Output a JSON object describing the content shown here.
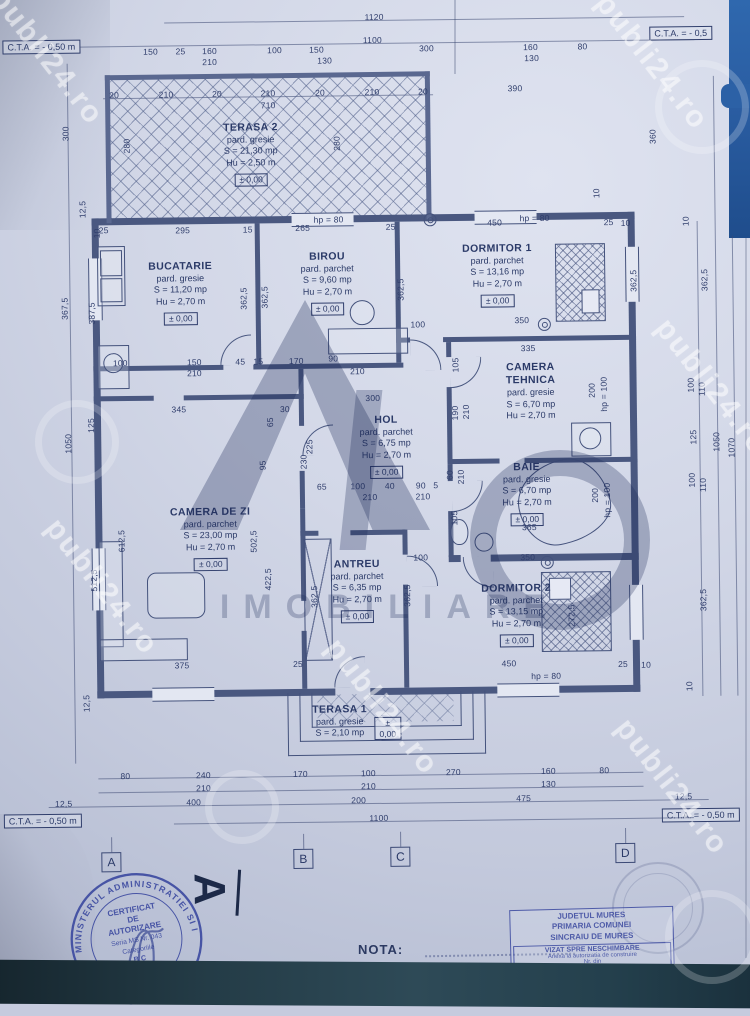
{
  "cta": {
    "top_left": "C.T.A. = - 0,50 m",
    "top_right": "C.T.A. = - 0,5",
    "bottom_left": "C.T.A. = - 0,50 m",
    "bottom_right": "C.T.A. = - 0,50 m"
  },
  "nota": "NOTA:",
  "section_marker": "A",
  "watermark": {
    "site": "publi24.ro",
    "logo_text": "IMOBILIARE"
  },
  "grid_letters": [
    {
      "t": "A",
      "x": 107,
      "y": 849
    },
    {
      "t": "B",
      "x": 299,
      "y": 848
    },
    {
      "t": "C",
      "x": 396,
      "y": 847
    },
    {
      "t": "D",
      "x": 621,
      "y": 846
    }
  ],
  "rooms": [
    {
      "name": "TERASA 2",
      "lines": [
        "pard. gresie",
        "S = 21,30 mp",
        "Hu = 2,50 m"
      ],
      "elev": "± 0,00",
      "x": 255,
      "y": 120
    },
    {
      "name": "BUCATARIE",
      "lines": [
        "pard. gresie",
        "S = 11,20 mp",
        "Hu = 2,70 m"
      ],
      "elev": "± 0,00",
      "x": 183,
      "y": 258
    },
    {
      "name": "BIROU",
      "lines": [
        "pard. parchet",
        "S = 9,60 mp",
        "Hu = 2,70 m"
      ],
      "elev": "± 0,00",
      "x": 330,
      "y": 250
    },
    {
      "name": "DORMITOR 1",
      "lines": [
        "pard. parchet",
        "S = 13,16 mp",
        "Hu = 2,70 m"
      ],
      "elev": "± 0,00",
      "x": 500,
      "y": 244
    },
    {
      "name": "CAMERA TEHNICA",
      "lines": [
        "pard. gresie",
        "S = 6,70 mp",
        "Hu = 2,70 m"
      ],
      "elev": "",
      "x": 532,
      "y": 363,
      "nameWidth": 70
    },
    {
      "name": "HOL",
      "lines": [
        "pard. parchet",
        "S = 6,75 mp",
        "Hu = 2,70 m"
      ],
      "elev": "± 0,00",
      "x": 387,
      "y": 414
    },
    {
      "name": "BAIE",
      "lines": [
        "pard. gresie",
        "S = 6,70 mp",
        "Hu = 2,70 m"
      ],
      "elev": "± 0,00",
      "x": 527,
      "y": 463
    },
    {
      "name": "CAMERA DE ZI",
      "lines": [
        "pard. parchet",
        "S = 23,00 mp",
        "Hu = 2,70 m"
      ],
      "elev": "± 0,00",
      "x": 210,
      "y": 504
    },
    {
      "name": "ANTREU",
      "lines": [
        "pard. parchet",
        "S = 6,35 mp",
        "Hu = 2,70 m"
      ],
      "elev": "± 0,00",
      "x": 356,
      "y": 558
    },
    {
      "name": "DORMITOR 2",
      "lines": [
        "pard. parchet",
        "S = 13,15 mp",
        "Hu = 2,70 m"
      ],
      "elev": "± 0,00",
      "x": 515,
      "y": 584
    },
    {
      "name": "TERASA 1",
      "lines": [
        "pard. gresie",
        "S = 2,10 mp"
      ],
      "elev": "± 0,00",
      "x": 337,
      "y": 703,
      "elevSide": true
    }
  ],
  "dims": [
    [
      "1120",
      380,
      17,
      0
    ],
    [
      "1100",
      378,
      40,
      0
    ],
    [
      "150",
      156,
      49,
      0
    ],
    [
      "25",
      186,
      49,
      0
    ],
    [
      "160",
      215,
      49,
      0
    ],
    [
      "100",
      280,
      49,
      0
    ],
    [
      "150",
      322,
      49,
      0
    ],
    [
      "300",
      432,
      49,
      0
    ],
    [
      "160",
      536,
      49,
      0
    ],
    [
      "80",
      588,
      49,
      0
    ],
    [
      "210",
      215,
      60,
      0
    ],
    [
      "130",
      330,
      60,
      0
    ],
    [
      "130",
      537,
      60,
      0
    ],
    [
      "20",
      119,
      92,
      0
    ],
    [
      "210",
      171,
      92,
      0
    ],
    [
      "20",
      222,
      92,
      0
    ],
    [
      "210",
      273,
      92,
      0
    ],
    [
      "20",
      325,
      92,
      0
    ],
    [
      "210",
      377,
      92,
      0
    ],
    [
      "20",
      428,
      92,
      0
    ],
    [
      "710",
      273,
      104,
      0
    ],
    [
      "390",
      520,
      90,
      0
    ],
    [
      "280",
      131,
      143,
      1
    ],
    [
      "280",
      341,
      143,
      1
    ],
    [
      "360",
      657,
      140,
      1
    ],
    [
      "10",
      600,
      196,
      1
    ],
    [
      "25",
      107,
      227,
      0
    ],
    [
      "295",
      186,
      228,
      0
    ],
    [
      "15",
      251,
      228,
      0
    ],
    [
      "265",
      306,
      227,
      0
    ],
    [
      "hp = 80",
      332,
      219,
      0
    ],
    [
      "25",
      394,
      227,
      0
    ],
    [
      "450",
      498,
      224,
      0
    ],
    [
      "hp = 80",
      538,
      220,
      0
    ],
    [
      "25",
      612,
      225,
      0
    ],
    [
      "10",
      629,
      226,
      0
    ],
    [
      "12,5",
      86,
      206,
      1
    ],
    [
      "300",
      70,
      130,
      1
    ],
    [
      "367,5",
      67,
      305,
      1
    ],
    [
      "387,5",
      94,
      310,
      1
    ],
    [
      "125",
      92,
      422,
      1
    ],
    [
      "1050",
      69,
      440,
      1
    ],
    [
      "612,5",
      121,
      538,
      1
    ],
    [
      "512,5",
      93,
      577,
      1
    ],
    [
      "12,5",
      84,
      700,
      1
    ],
    [
      "10",
      100,
      230,
      1
    ],
    [
      "10",
      689,
      225,
      1
    ],
    [
      "362,5",
      707,
      284,
      1
    ],
    [
      "100",
      692,
      389,
      1
    ],
    [
      "110",
      703,
      393,
      1
    ],
    [
      "125",
      694,
      441,
      1
    ],
    [
      "1050",
      717,
      446,
      1
    ],
    [
      "1070",
      732,
      452,
      1
    ],
    [
      "100",
      692,
      484,
      1
    ],
    [
      "110",
      703,
      489,
      1
    ],
    [
      "362,5",
      702,
      604,
      1
    ],
    [
      "10",
      687,
      690,
      1
    ],
    [
      "362,5",
      246,
      297,
      1
    ],
    [
      "362,5",
      267,
      296,
      1
    ],
    [
      "362,5",
      403,
      290,
      1
    ],
    [
      "362,5",
      636,
      284,
      1
    ],
    [
      "105",
      457,
      366,
      1
    ],
    [
      "190",
      456,
      414,
      1
    ],
    [
      "210",
      467,
      413,
      1
    ],
    [
      "200",
      593,
      393,
      1
    ],
    [
      "hp = 100",
      605,
      397,
      1
    ],
    [
      "225",
      310,
      446,
      1
    ],
    [
      "230",
      304,
      461,
      1
    ],
    [
      "95",
      263,
      464,
      1
    ],
    [
      "30",
      286,
      408,
      0
    ],
    [
      "65",
      271,
      421,
      1
    ],
    [
      "60",
      450,
      476,
      1
    ],
    [
      "210",
      461,
      478,
      1
    ],
    [
      "105",
      454,
      519,
      1
    ],
    [
      "200",
      595,
      498,
      1
    ],
    [
      "hp = 100",
      607,
      503,
      1
    ],
    [
      "502,5",
      253,
      540,
      1
    ],
    [
      "422,5",
      267,
      578,
      1
    ],
    [
      "362,5",
      313,
      596,
      1
    ],
    [
      "362,5",
      406,
      596,
      1
    ],
    [
      "272,5",
      570,
      618,
      1
    ],
    [
      "100",
      420,
      325,
      0
    ],
    [
      "350",
      524,
      322,
      0
    ],
    [
      "335",
      530,
      350,
      0
    ],
    [
      "300",
      374,
      398,
      0
    ],
    [
      "345",
      180,
      407,
      0
    ],
    [
      "65",
      322,
      486,
      0
    ],
    [
      "100",
      358,
      486,
      0
    ],
    [
      "40",
      390,
      486,
      0
    ],
    [
      "90",
      421,
      486,
      0
    ],
    [
      "5",
      436,
      486,
      0
    ],
    [
      "210",
      370,
      497,
      0
    ],
    [
      "210",
      423,
      497,
      0
    ],
    [
      "100",
      122,
      360,
      0
    ],
    [
      "150",
      196,
      360,
      0
    ],
    [
      "45",
      242,
      360,
      0
    ],
    [
      "15",
      260,
      360,
      0
    ],
    [
      "170",
      298,
      360,
      0
    ],
    [
      "90",
      335,
      358,
      0
    ],
    [
      "210",
      196,
      371,
      0
    ],
    [
      "210",
      359,
      371,
      0
    ],
    [
      "365",
      529,
      529,
      0
    ],
    [
      "350",
      527,
      559,
      0
    ],
    [
      "100",
      420,
      558,
      0
    ],
    [
      "375",
      180,
      663,
      0
    ],
    [
      "25",
      296,
      663,
      0
    ],
    [
      "450",
      507,
      665,
      0
    ],
    [
      "hp = 80",
      544,
      678,
      0
    ],
    [
      "25",
      621,
      667,
      0
    ],
    [
      "10",
      644,
      668,
      0
    ],
    [
      "80",
      122,
      773,
      0
    ],
    [
      "240",
      200,
      773,
      0
    ],
    [
      "170",
      297,
      773,
      0
    ],
    [
      "100",
      365,
      773,
      0
    ],
    [
      "270",
      450,
      773,
      0
    ],
    [
      "160",
      545,
      773,
      0
    ],
    [
      "80",
      601,
      773,
      0
    ],
    [
      "210",
      200,
      786,
      0
    ],
    [
      "210",
      365,
      786,
      0
    ],
    [
      "130",
      545,
      786,
      0
    ],
    [
      "12,5",
      60,
      800,
      0
    ],
    [
      "400",
      190,
      800,
      0
    ],
    [
      "200",
      355,
      800,
      0
    ],
    [
      "475",
      520,
      800,
      0
    ],
    [
      "12,5",
      680,
      800,
      0
    ],
    [
      "1100",
      375,
      818,
      0
    ]
  ],
  "stamps": {
    "round": {
      "ring": "MINISTERUL ADMINISTRATIEI SI INTERNELOR",
      "l1": "CERTIFICAT",
      "l2": "DE",
      "l3": "AUTORIZARE",
      "l4": "Seria MS Nr. 043",
      "l5": "Categoriile",
      "l6": "B C",
      "l7": "MURAR CIPRIAN",
      "bottom": "★ ANCPI ★"
    },
    "box": {
      "header": [
        "JUDETUL MURES",
        "PRIMARIA COMUNEI",
        "SINCRAIU DE MURES"
      ],
      "inner_title": "VIZAT SPRE NESCHIMBARE",
      "inner_lines": [
        "Anexa la autorizatia de construire",
        "Nr.        din"
      ]
    }
  }
}
